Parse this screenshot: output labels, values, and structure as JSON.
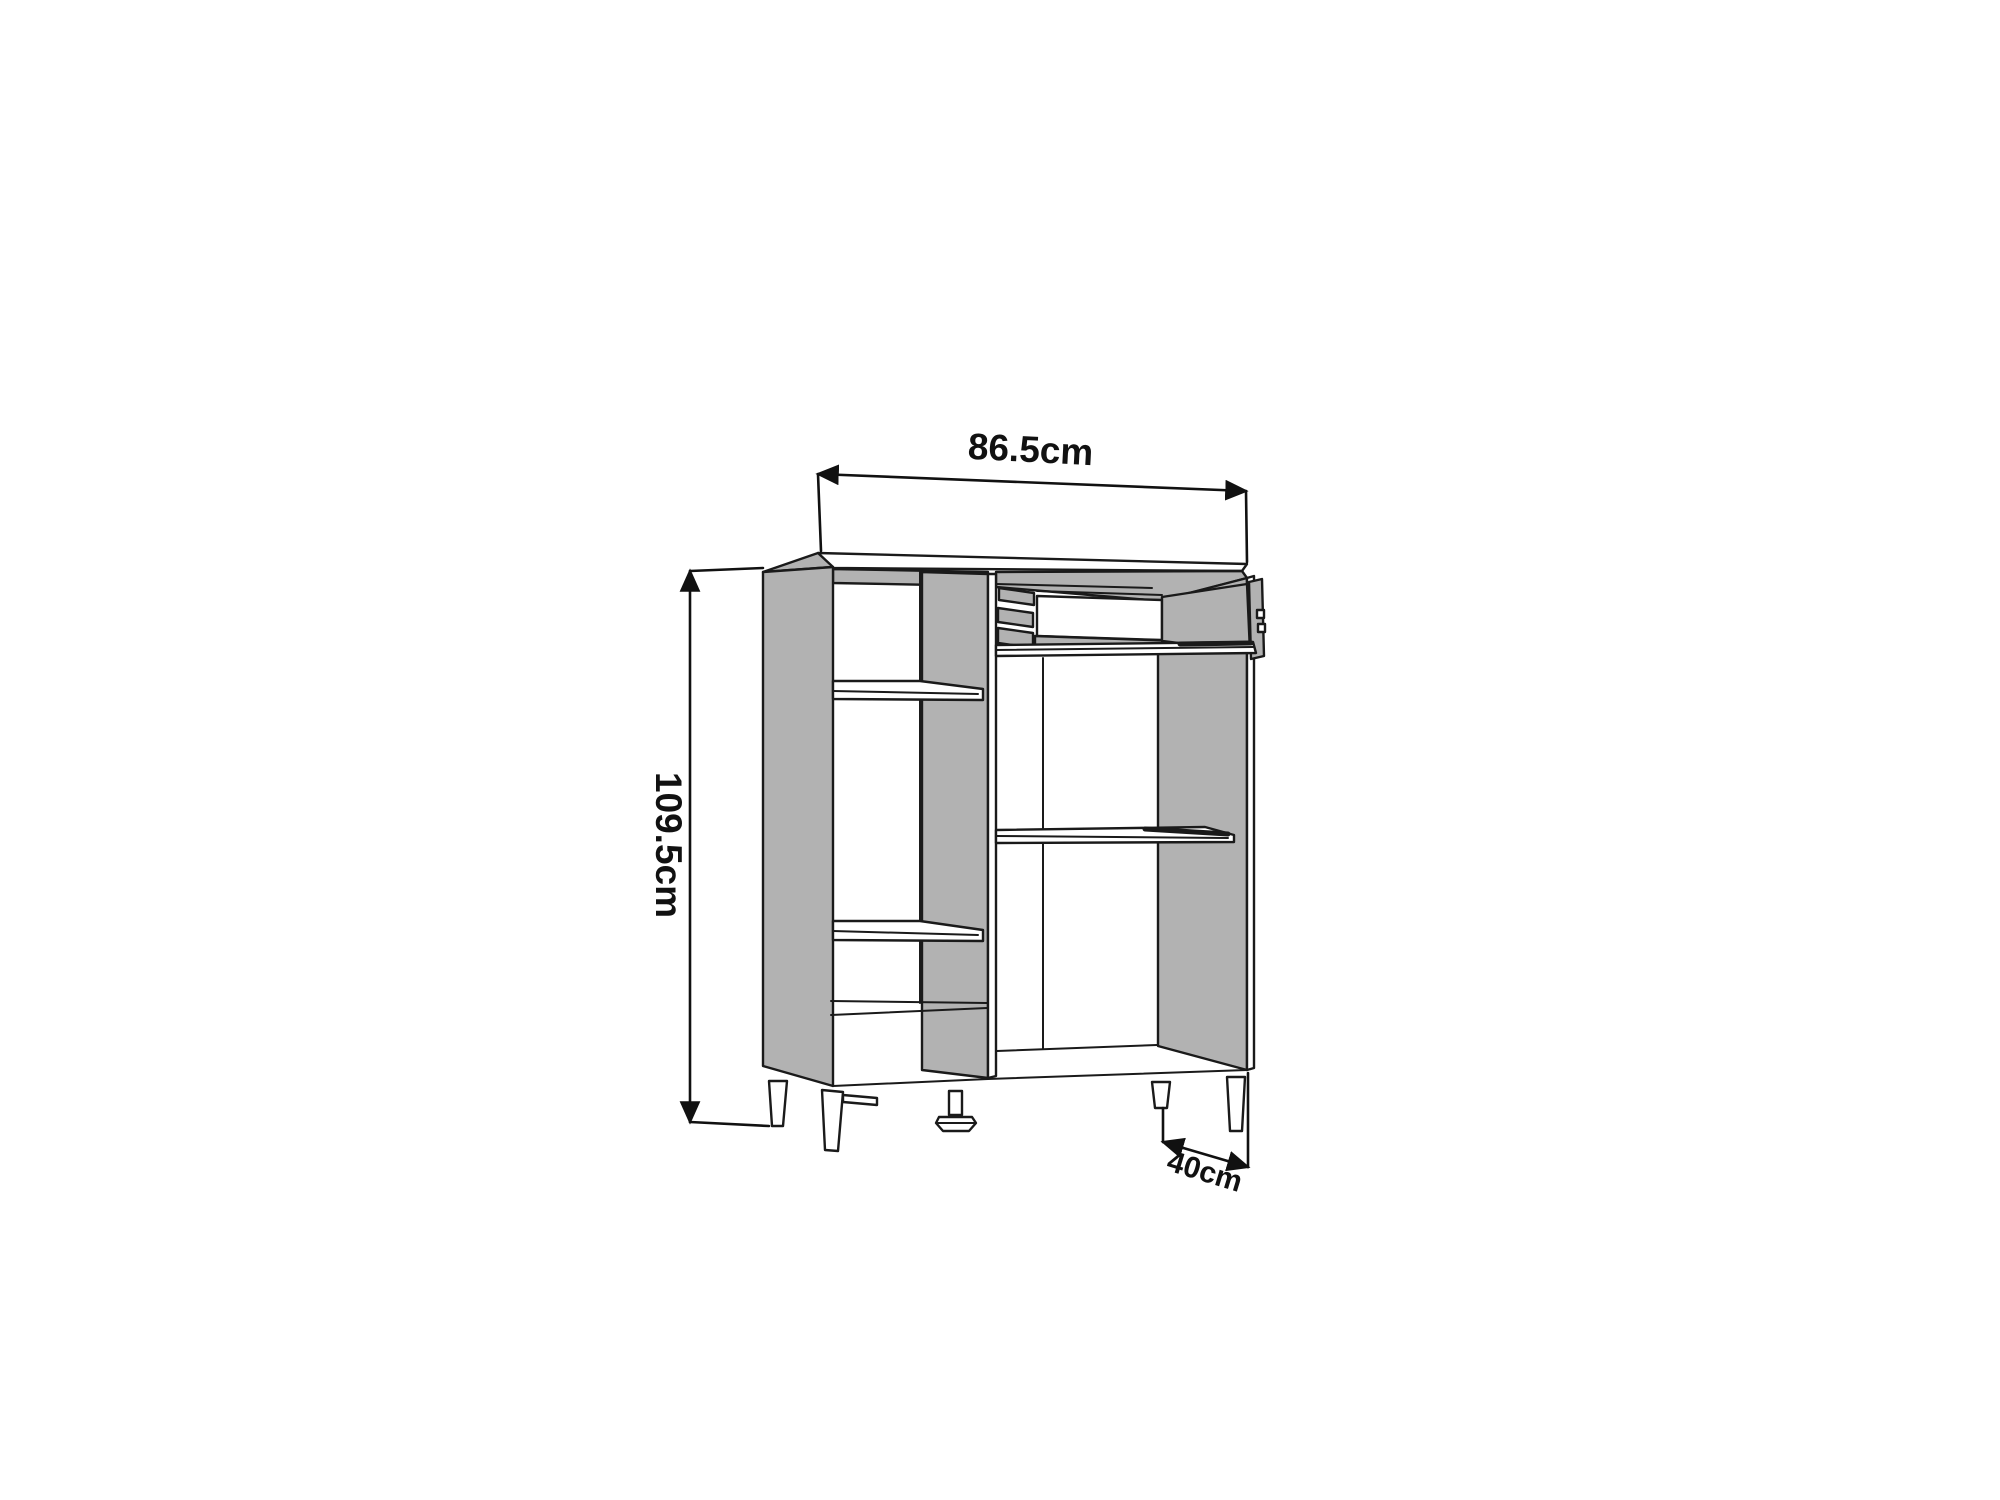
{
  "diagram": {
    "labels": {
      "width": "86.5cm",
      "height": "109.5cm",
      "depth": "40cm"
    },
    "colors": {
      "line": "#1a1a1a",
      "panel_gray": "#b2b2b2",
      "background": "#ffffff"
    }
  }
}
